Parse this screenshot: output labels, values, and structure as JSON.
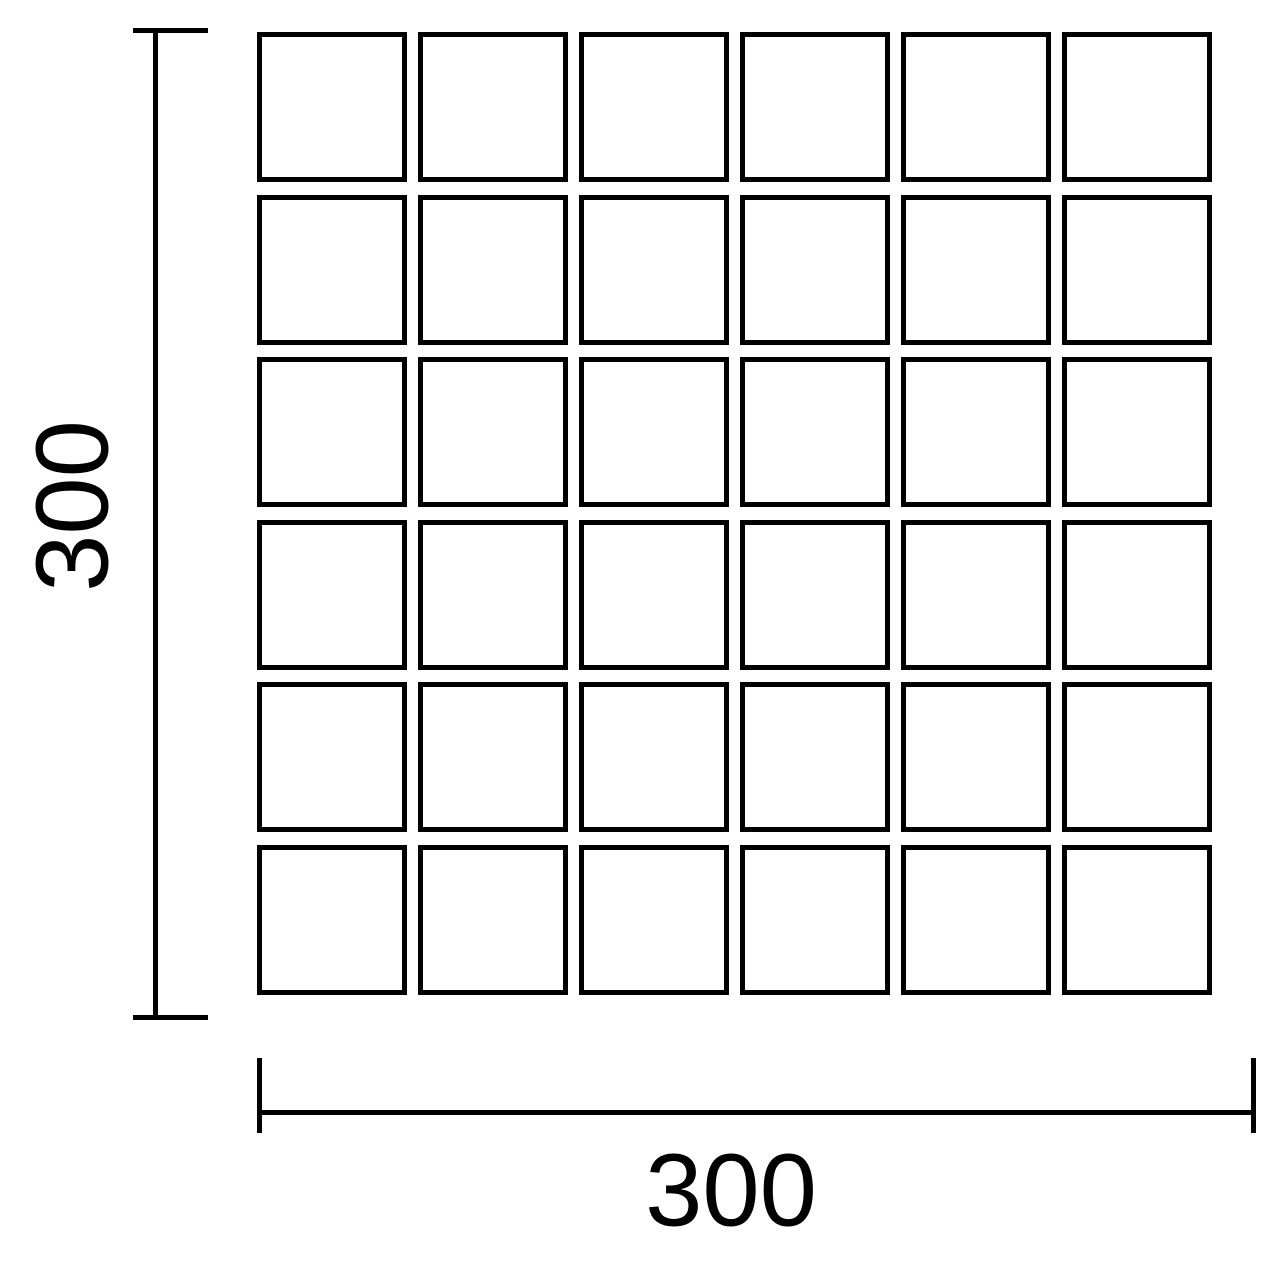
{
  "diagram": {
    "grid": {
      "rows": 6,
      "columns": 6
    },
    "dimensions": {
      "height_label": "300",
      "width_label": "300"
    },
    "colors": {
      "line": "#000000",
      "background": "#ffffff"
    }
  }
}
